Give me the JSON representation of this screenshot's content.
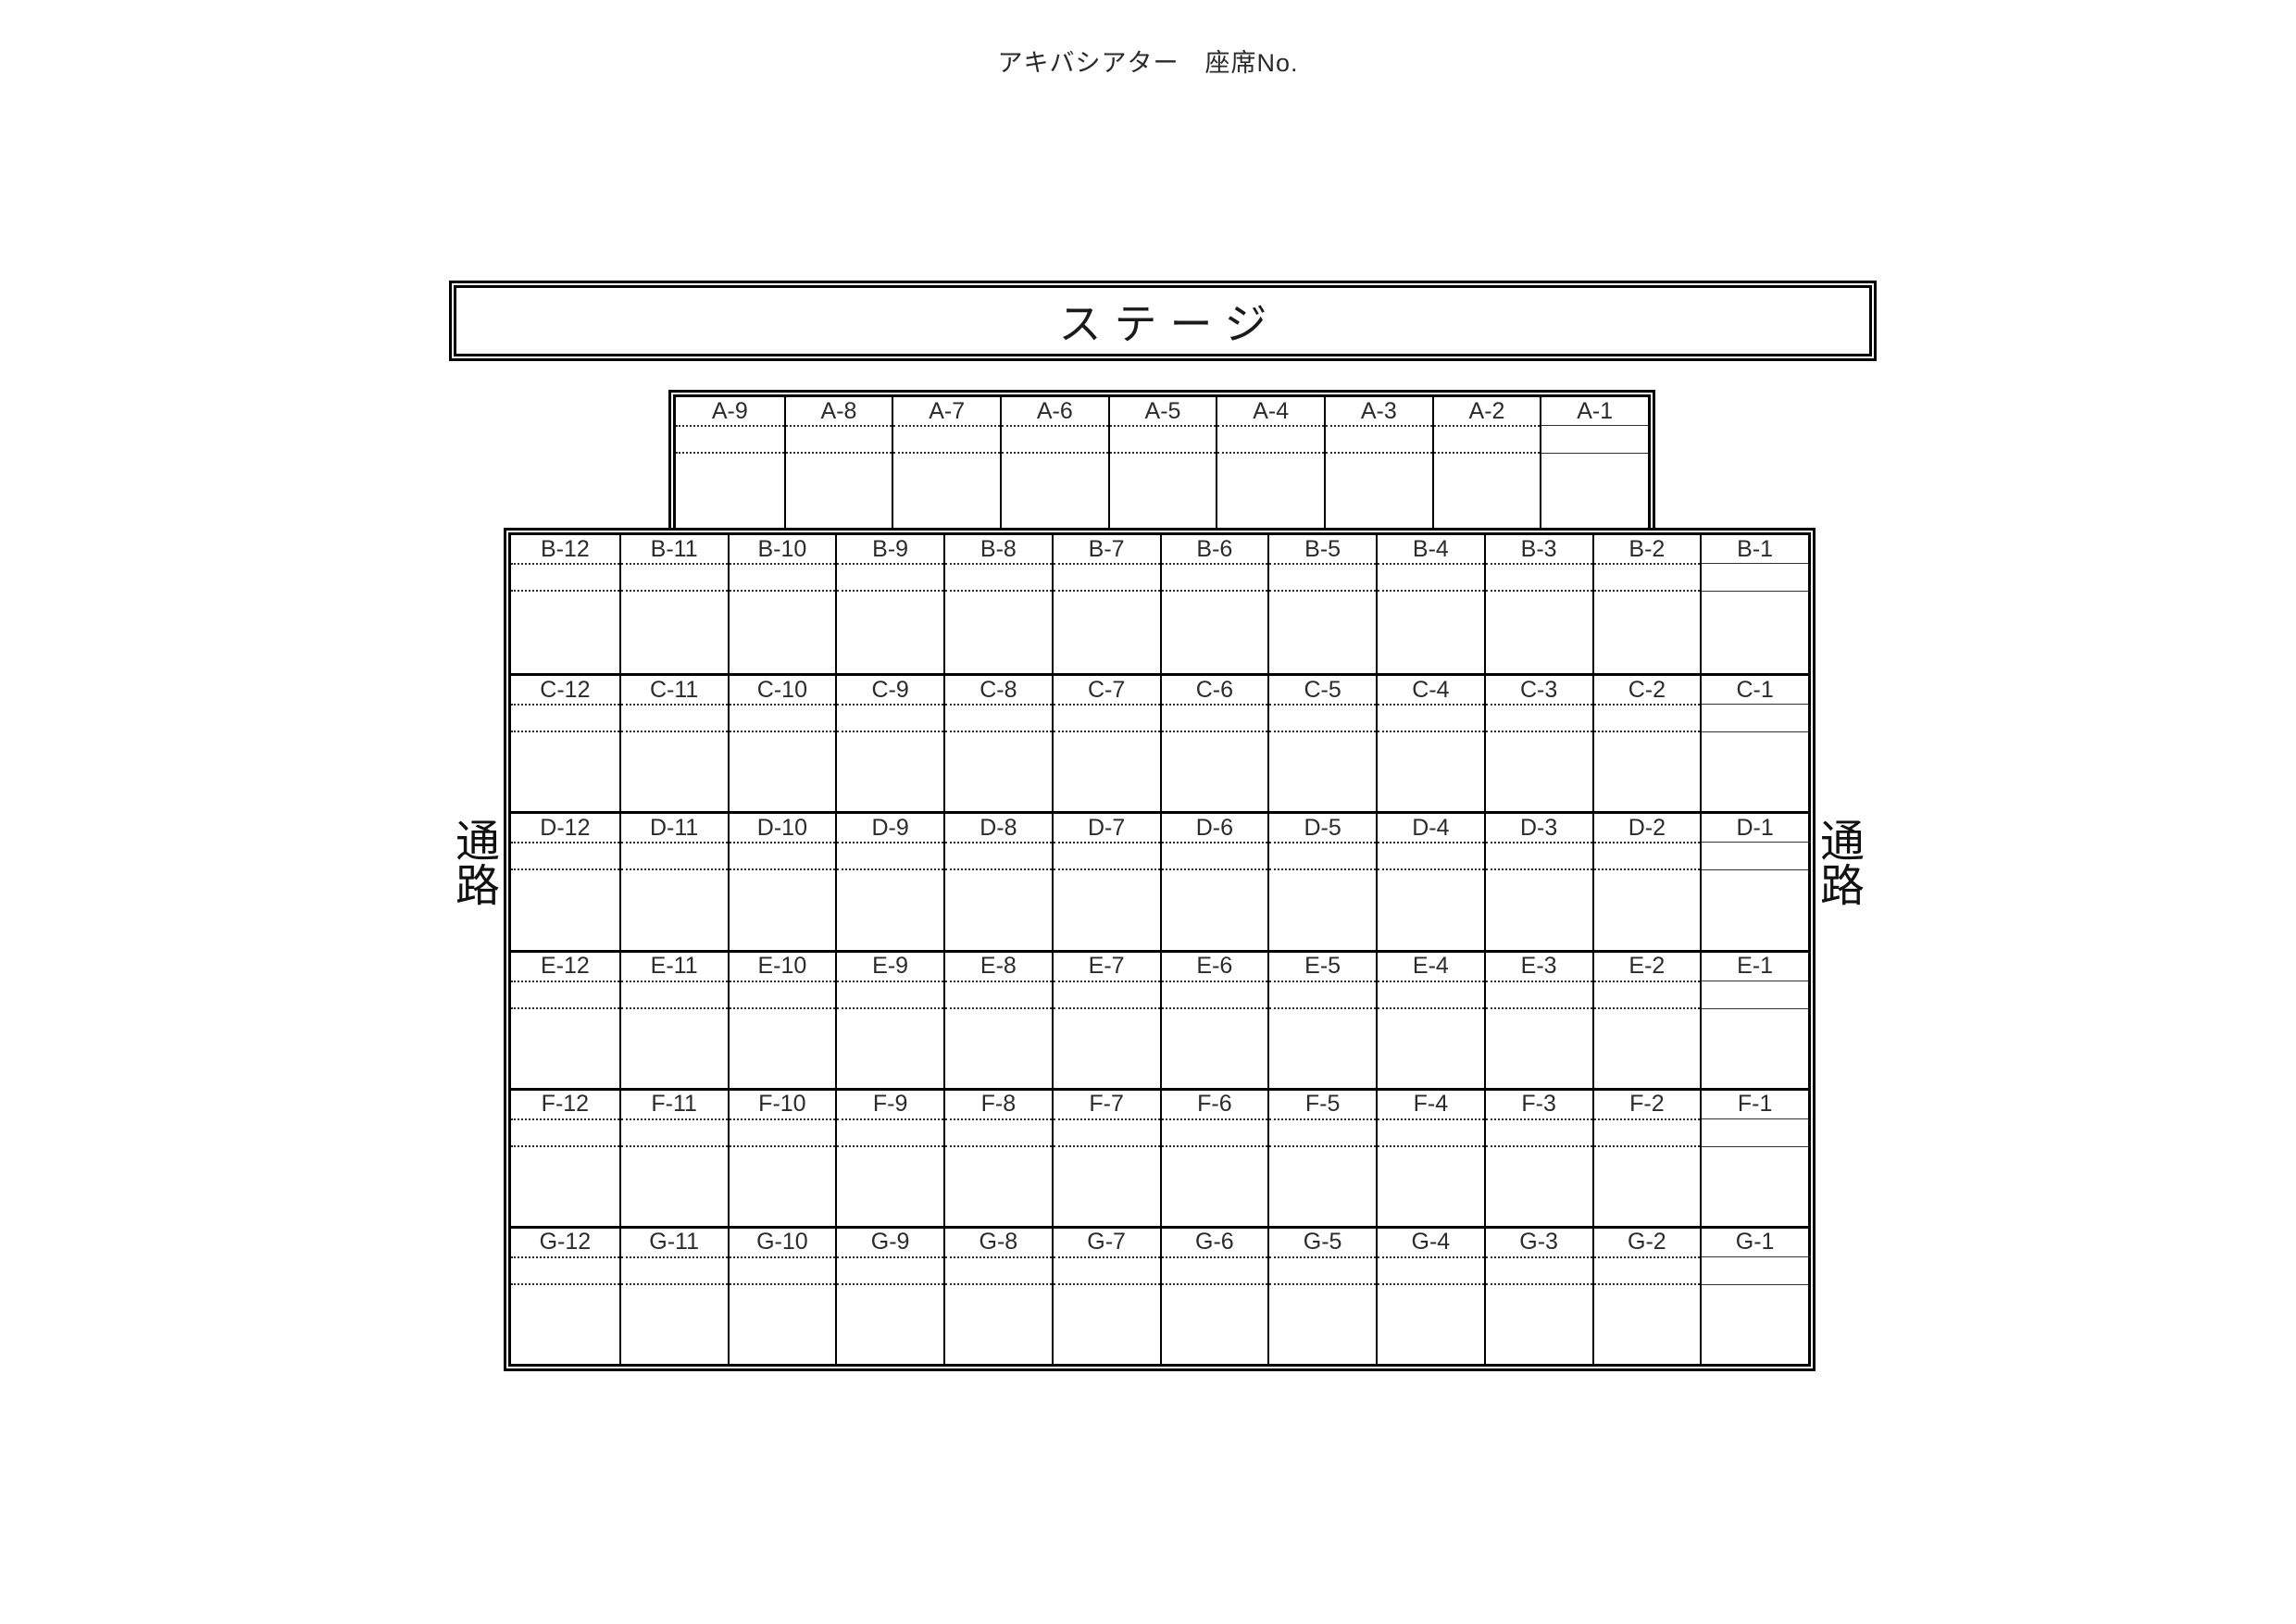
{
  "page": {
    "title": "アキバシアター　座席No."
  },
  "stage": {
    "label": "ステージ"
  },
  "aisles": {
    "left": "通路",
    "right": "通路"
  },
  "seat_map": {
    "front_row": {
      "row": "A",
      "seats": [
        "A-9",
        "A-8",
        "A-7",
        "A-6",
        "A-5",
        "A-4",
        "A-3",
        "A-2",
        "A-1"
      ]
    },
    "rows": [
      {
        "row": "B",
        "seats": [
          "B-12",
          "B-11",
          "B-10",
          "B-9",
          "B-8",
          "B-7",
          "B-6",
          "B-5",
          "B-4",
          "B-3",
          "B-2",
          "B-1"
        ]
      },
      {
        "row": "C",
        "seats": [
          "C-12",
          "C-11",
          "C-10",
          "C-9",
          "C-8",
          "C-7",
          "C-6",
          "C-5",
          "C-4",
          "C-3",
          "C-2",
          "C-1"
        ]
      },
      {
        "row": "D",
        "seats": [
          "D-12",
          "D-11",
          "D-10",
          "D-9",
          "D-8",
          "D-7",
          "D-6",
          "D-5",
          "D-4",
          "D-3",
          "D-2",
          "D-1"
        ]
      },
      {
        "row": "E",
        "seats": [
          "E-12",
          "E-11",
          "E-10",
          "E-9",
          "E-8",
          "E-7",
          "E-6",
          "E-5",
          "E-4",
          "E-3",
          "E-2",
          "E-1"
        ]
      },
      {
        "row": "F",
        "seats": [
          "F-12",
          "F-11",
          "F-10",
          "F-9",
          "F-8",
          "F-7",
          "F-6",
          "F-5",
          "F-4",
          "F-3",
          "F-2",
          "F-1"
        ]
      },
      {
        "row": "G",
        "seats": [
          "G-12",
          "G-11",
          "G-10",
          "G-9",
          "G-8",
          "G-7",
          "G-6",
          "G-5",
          "G-4",
          "G-3",
          "G-2",
          "G-1"
        ]
      }
    ]
  },
  "colors": {
    "line": "#000000",
    "text": "#212121",
    "background": "#ffffff"
  }
}
